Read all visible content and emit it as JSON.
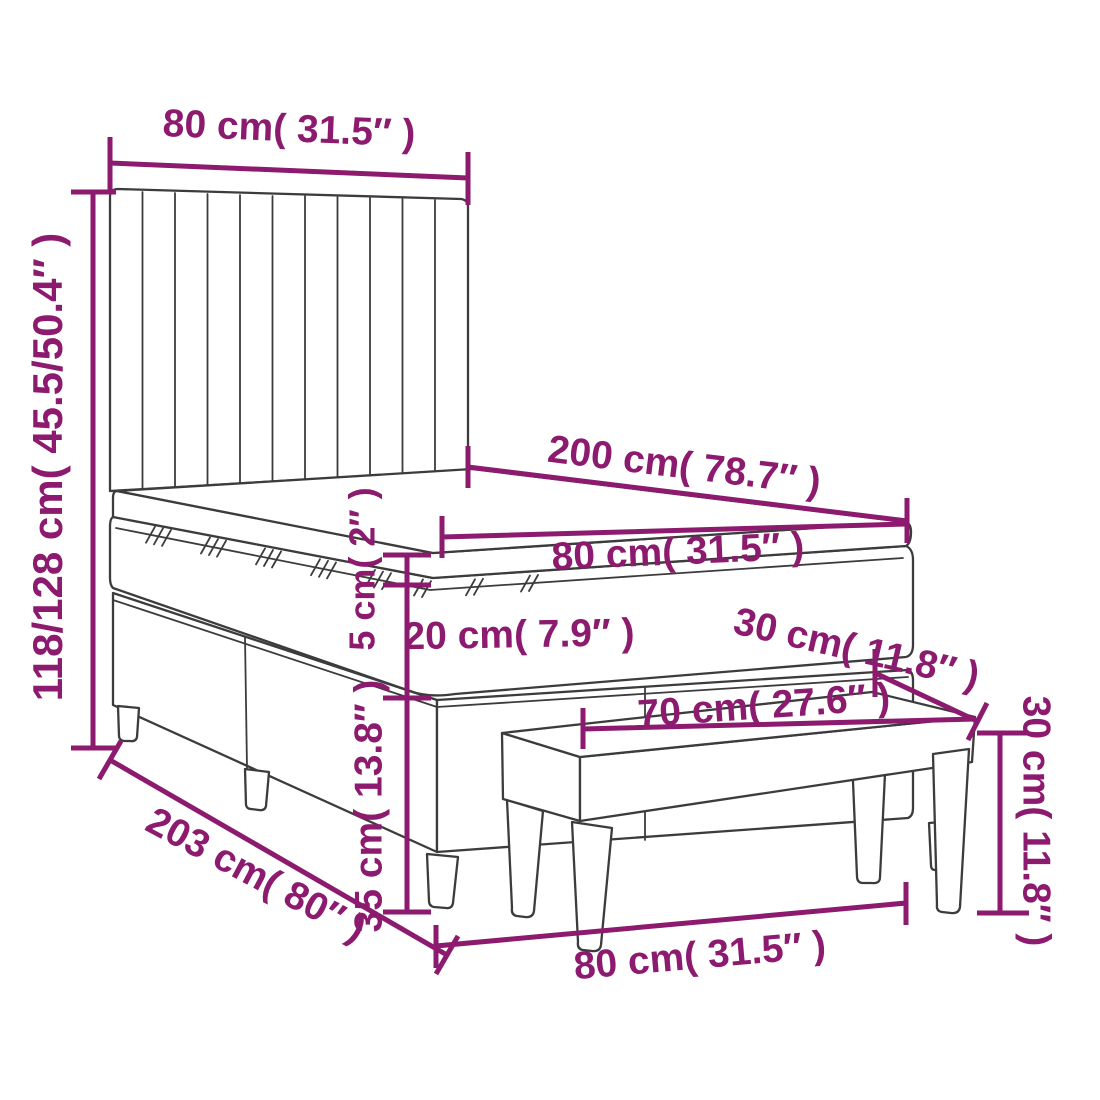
{
  "diagram": {
    "name": "bed-with-bench-dimension-diagram",
    "colors": {
      "dimension_color": "#8C1A6E",
      "outline_color": "#3C3C3C",
      "background": "#FFFFFF"
    },
    "labels": {
      "headboard_width": "80 cm( 31.5″ )",
      "overall_height": "118/128 cm( 45.5/50.4″ )",
      "bed_length": "200 cm( 78.7″ )",
      "mattress_width": "80 cm( 31.5″ )",
      "topper_thickness": "5 cm( 2″ )",
      "mattress_thickness": "20 cm( 7.9″ )",
      "base_height": "35 cm( 13.8″ )",
      "bench_depth": "30 cm( 11.8″ )",
      "bench_length": "70 cm( 27.6″ )",
      "bench_height": "30 cm( 11.8″ )",
      "frame_length": "203 cm( 80″ )",
      "frame_width": "80 cm( 31.5″ )"
    }
  }
}
